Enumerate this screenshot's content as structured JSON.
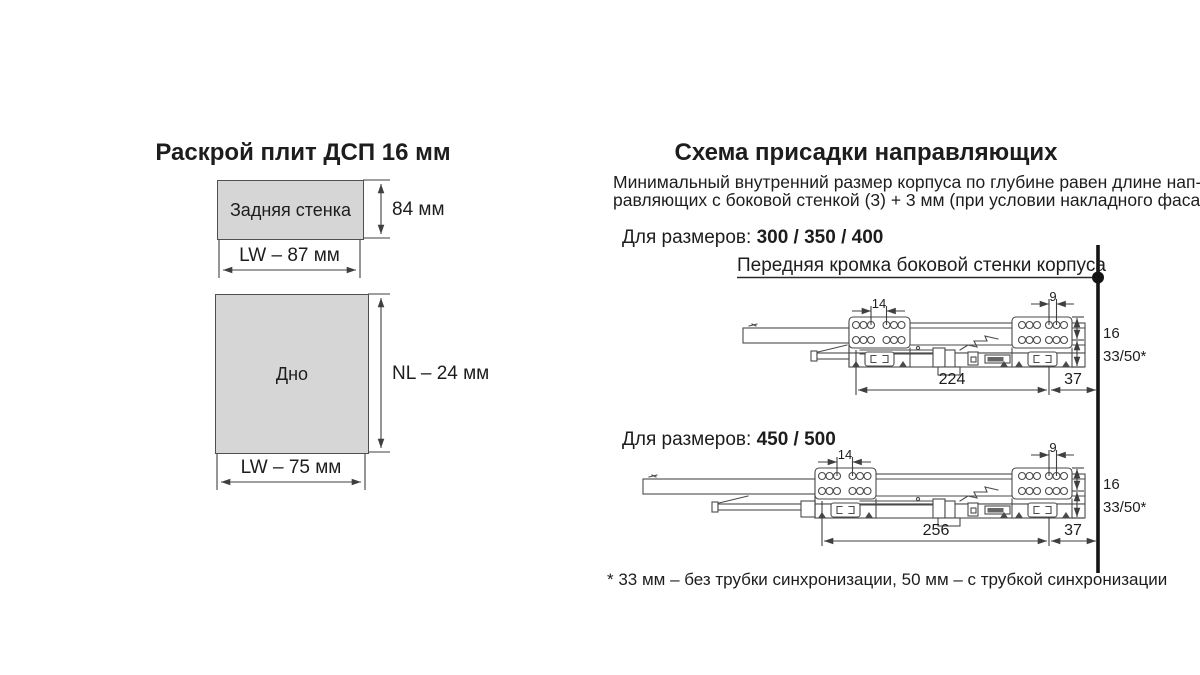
{
  "colors": {
    "panel_fill": "#d6d6d6",
    "line_color": "#4a4a4a",
    "text_color": "#1d1d1d"
  },
  "left_panel": {
    "title": "Раскрой плит ДСП 16 мм",
    "back_wall": {
      "label": "Задняя стенка",
      "height_dim": "84 мм",
      "width_dim": "LW – 87 мм"
    },
    "bottom_panel": {
      "label": "Дно",
      "height_dim": "NL – 24 мм",
      "width_dim": "LW – 75 мм"
    }
  },
  "right_panel": {
    "title": "Схема присадки направляющих",
    "description_line1": "Минимальный внутренний размер корпуса по глубине равен длине нап-",
    "description_line2": "равляющих с боковой стенкой (3) + 3 мм (при условии накладного фасада)",
    "front_edge_label": "Передняя кромка боковой стенки корпуса",
    "footnote": "* 33 мм – без трубки синхронизации, 50 мм – с трубкой синхронизации",
    "drawings": [
      {
        "sizes_label": "Для размеров:",
        "sizes_values": "300 / 350 / 400",
        "dims": {
          "front_hole_spacing": "14",
          "rear_hole_spacing": "9",
          "row_spacing": "16",
          "bottom_offset": "33/50*",
          "length": "224",
          "front_offset": "37"
        }
      },
      {
        "sizes_label": "Для размеров:",
        "sizes_values": "450 / 500",
        "dims": {
          "front_hole_spacing": "14",
          "rear_hole_spacing": "9",
          "row_spacing": "16",
          "bottom_offset": "33/50*",
          "length": "256",
          "front_offset": "37"
        }
      }
    ]
  }
}
